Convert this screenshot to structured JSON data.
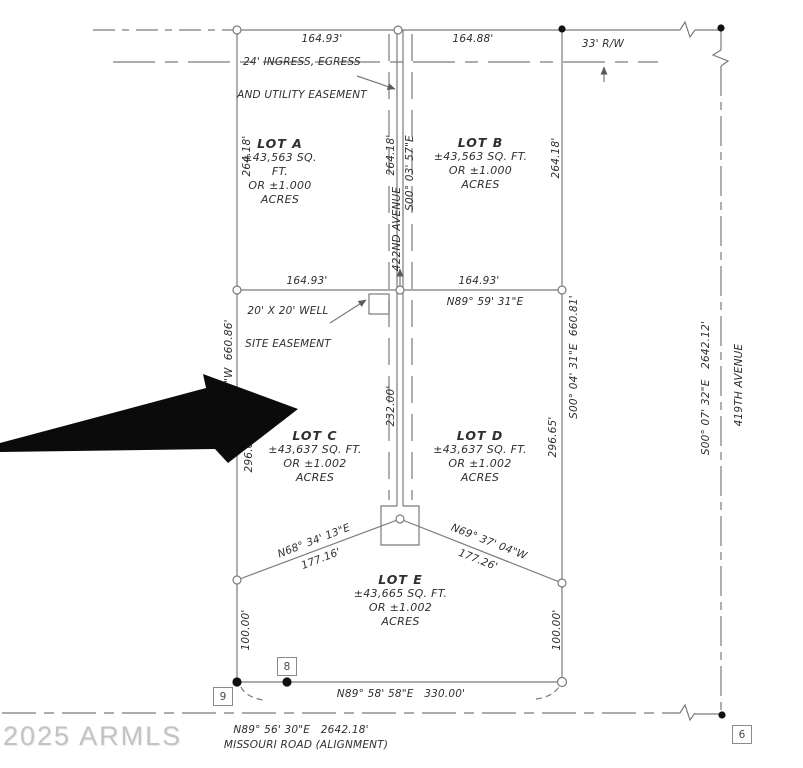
{
  "watermark": "2025 ARMLS",
  "lots": {
    "a": {
      "lines": [
        "LOT A",
        "±43,563 SQ.",
        "FT.",
        "OR ±1.000",
        "ACRES"
      ]
    },
    "b": {
      "lines": [
        "LOT B",
        "±43,563 SQ. FT.",
        "OR ±1.000",
        "ACRES"
      ]
    },
    "c": {
      "lines": [
        "LOT C",
        "±43,637 SQ. FT.",
        "OR ±1.002",
        "ACRES"
      ]
    },
    "d": {
      "lines": [
        "LOT D",
        "±43,637 SQ. FT.",
        "OR ±1.002",
        "ACRES"
      ]
    },
    "e": {
      "lines": [
        "LOT E",
        "±43,665 SQ. FT.",
        "OR ±1.002",
        "ACRES"
      ]
    }
  },
  "dims": {
    "top_left": "164.93'",
    "top_right": "164.88'",
    "rw": "33' R/W",
    "lot_a_west": "264.18'",
    "lot_b_east": "264.18'",
    "ave_dim": "264.18'",
    "ave_bearing": "S00° 03' 57\"E",
    "ave_name": "422ND AVENUE",
    "mid_left": "164.93'",
    "mid_right": "164.93'",
    "mid_bearing": "N89° 59' 31\"E",
    "west_bearing": "S00° 03' 22\"W  660.86'",
    "west_mid": "296.68'",
    "east_bearing": "S00° 04' 31\"E  660.81'",
    "east_mid": "296.65'",
    "ave_lower": "232.00'",
    "diag_left_bearing": "N68° 34' 13\"E",
    "diag_left_len": "177.16'",
    "diag_right_bearing": "N69° 37' 04\"W",
    "diag_right_len": "177.26'",
    "lot_e_west": "100.00'",
    "lot_e_east": "100.00'",
    "south": "N89° 58' 58\"E   330.00'",
    "far_east_bearing": "S00° 07' 32\"E   2642.12'",
    "far_east_name": "419TH AVENUE",
    "road_bearing": "N89° 56' 30\"E   2642.18'",
    "road_name": "MISSOURI ROAD (ALIGNMENT)"
  },
  "notes": {
    "ingress_1": "24' INGRESS, EGRESS",
    "ingress_2": "AND UTILITY EASEMENT",
    "well_1": "20' X 20' WELL",
    "well_2": "SITE EASEMENT"
  },
  "markers": {
    "m6": "6",
    "m8": "8",
    "m9": "9"
  },
  "colors": {
    "line": "#7a7a7a",
    "text": "#2f2f2f",
    "arrow": "#0b0b0b",
    "watermark": "#c3c3c3"
  }
}
